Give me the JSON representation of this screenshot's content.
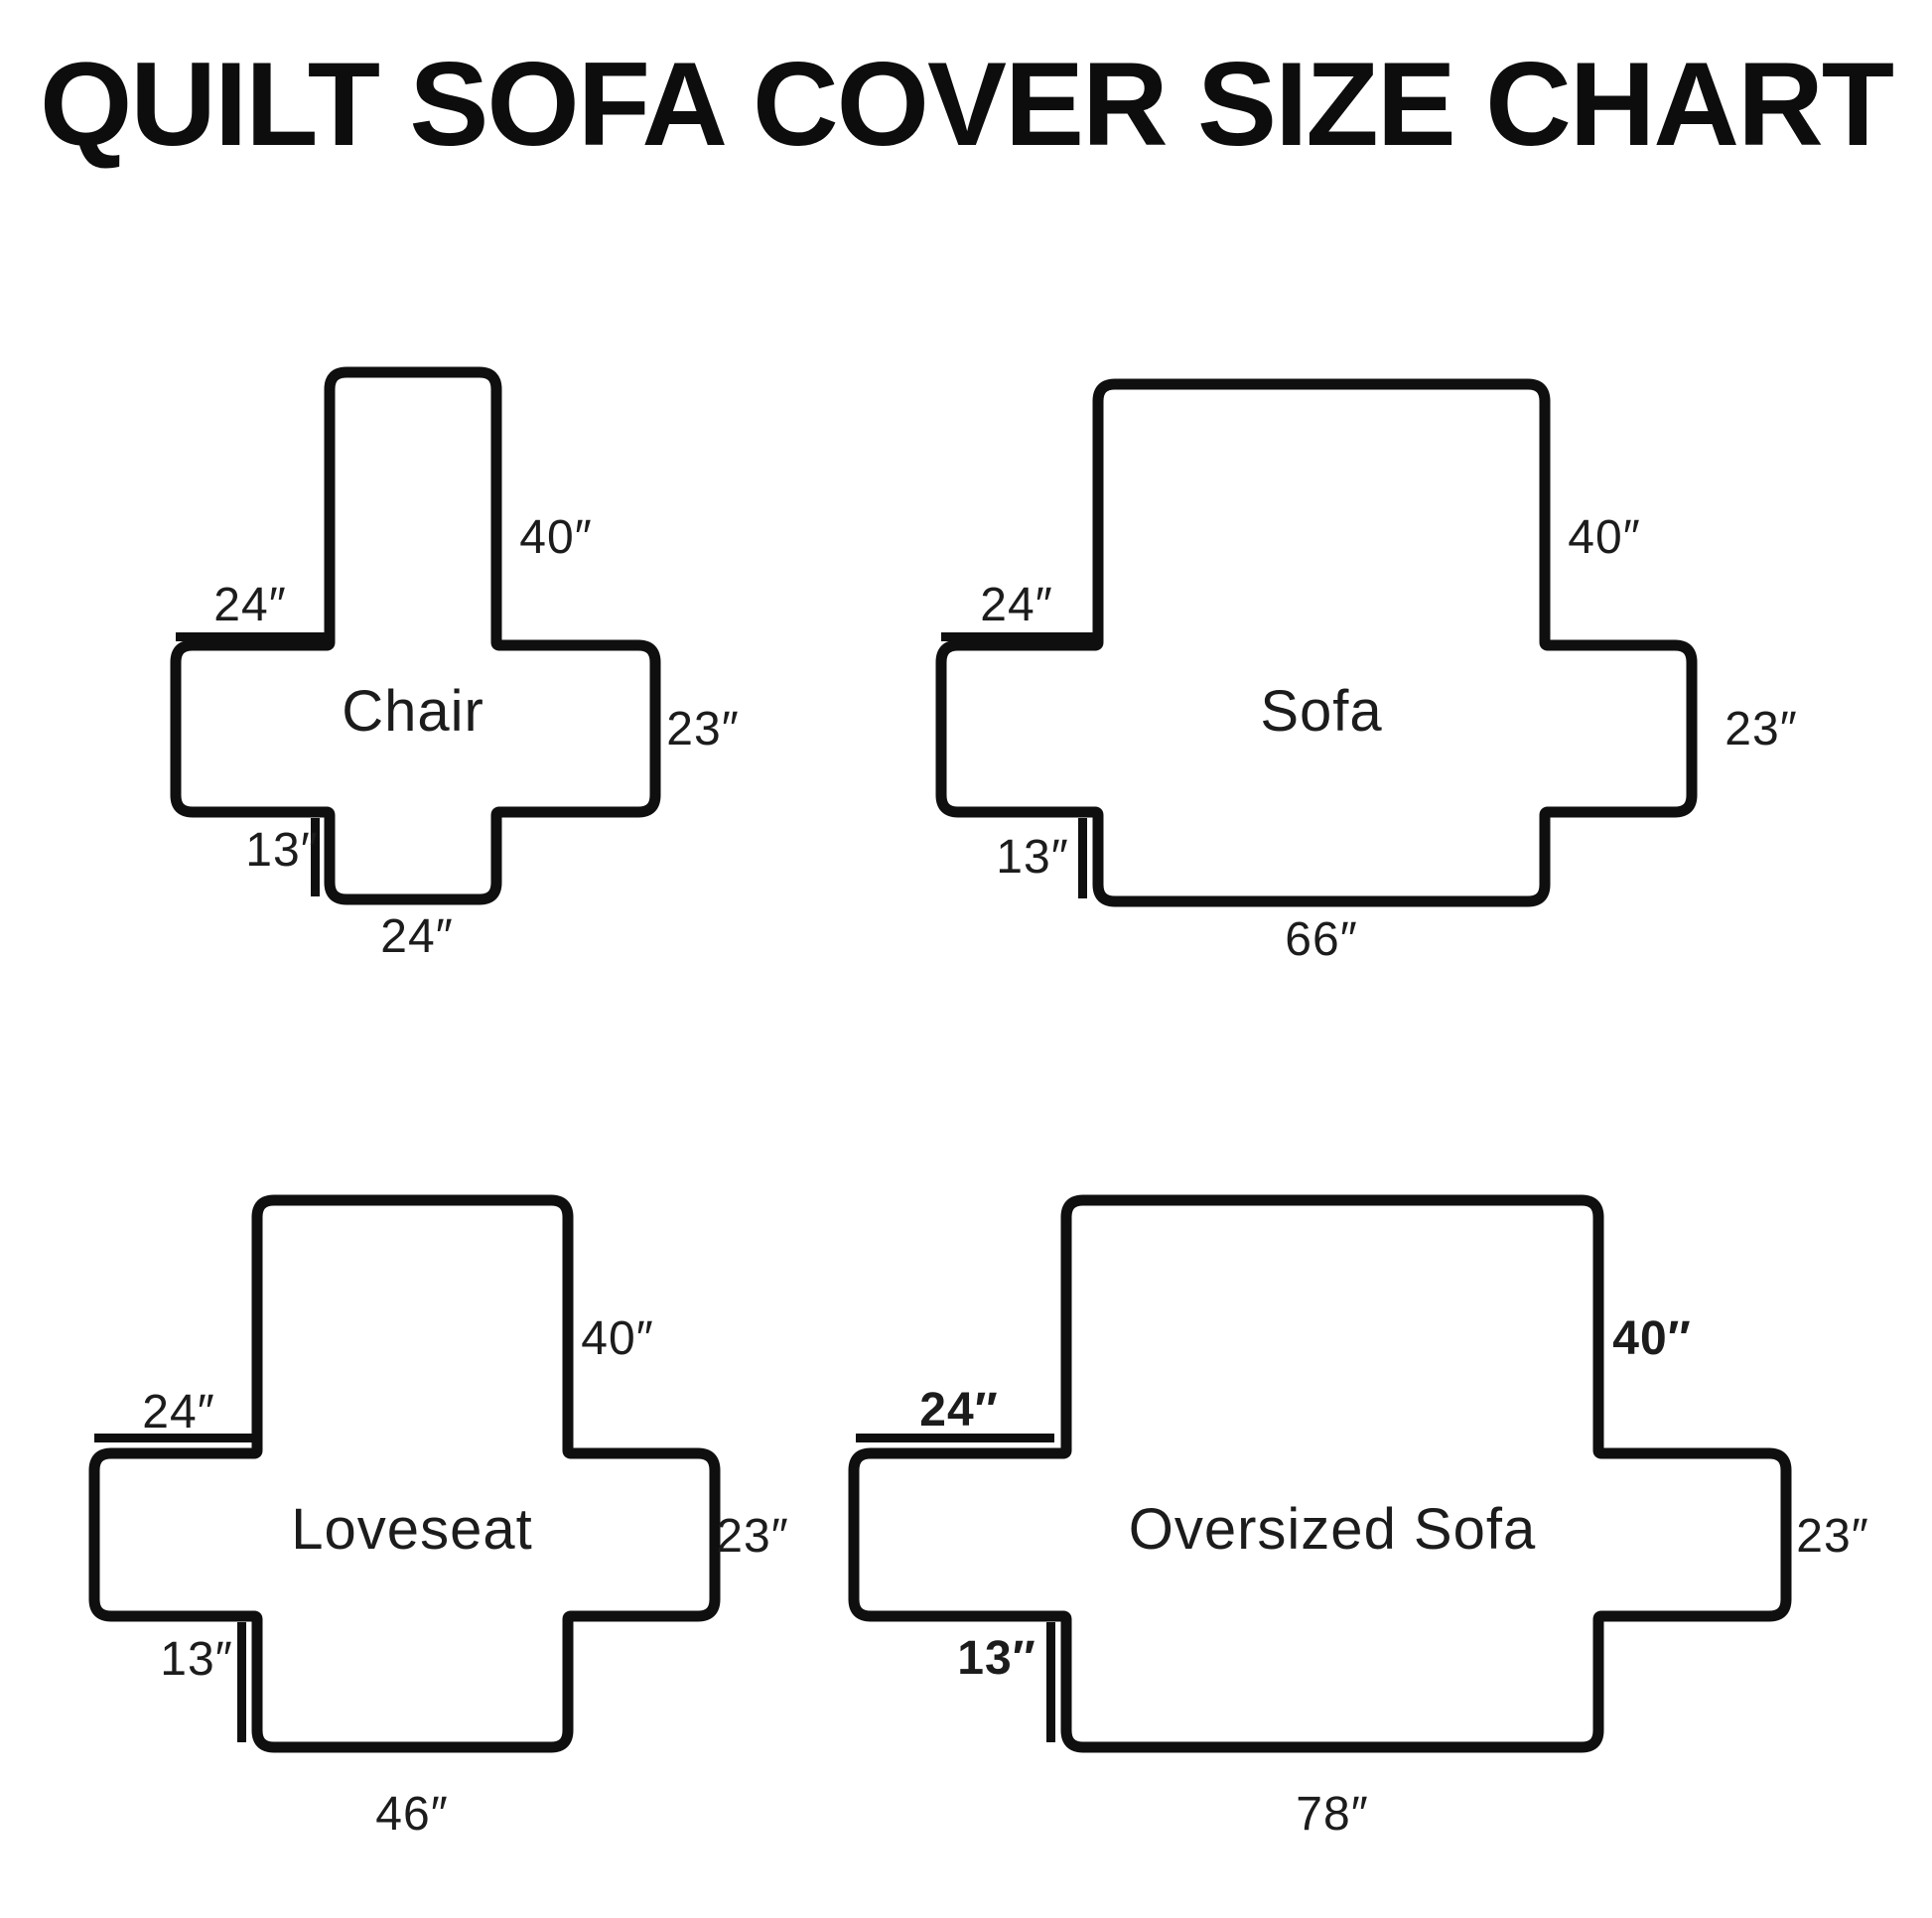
{
  "title": "QUILT SOFA COVER SIZE CHART",
  "colors": {
    "line": "#0f0f0f",
    "text": "#1c1c1c",
    "background": "#ffffff"
  },
  "diagrams": [
    {
      "name": "Chair",
      "back_height": "40″",
      "arm_depth": "24″",
      "side_height": "23″",
      "skirt_height": "13″",
      "seat_width": "24″"
    },
    {
      "name": "Sofa",
      "back_height": "40″",
      "arm_depth": "24″",
      "side_height": "23″",
      "skirt_height": "13″",
      "seat_width": "66″"
    },
    {
      "name": "Loveseat",
      "back_height": "40″",
      "arm_depth": "24″",
      "side_height": "23″",
      "skirt_height": "13″",
      "seat_width": "46″"
    },
    {
      "name": "Oversized Sofa",
      "back_height": "40″",
      "arm_depth": "24″",
      "side_height": "23″",
      "skirt_height": "13″",
      "seat_width": "78″"
    }
  ]
}
